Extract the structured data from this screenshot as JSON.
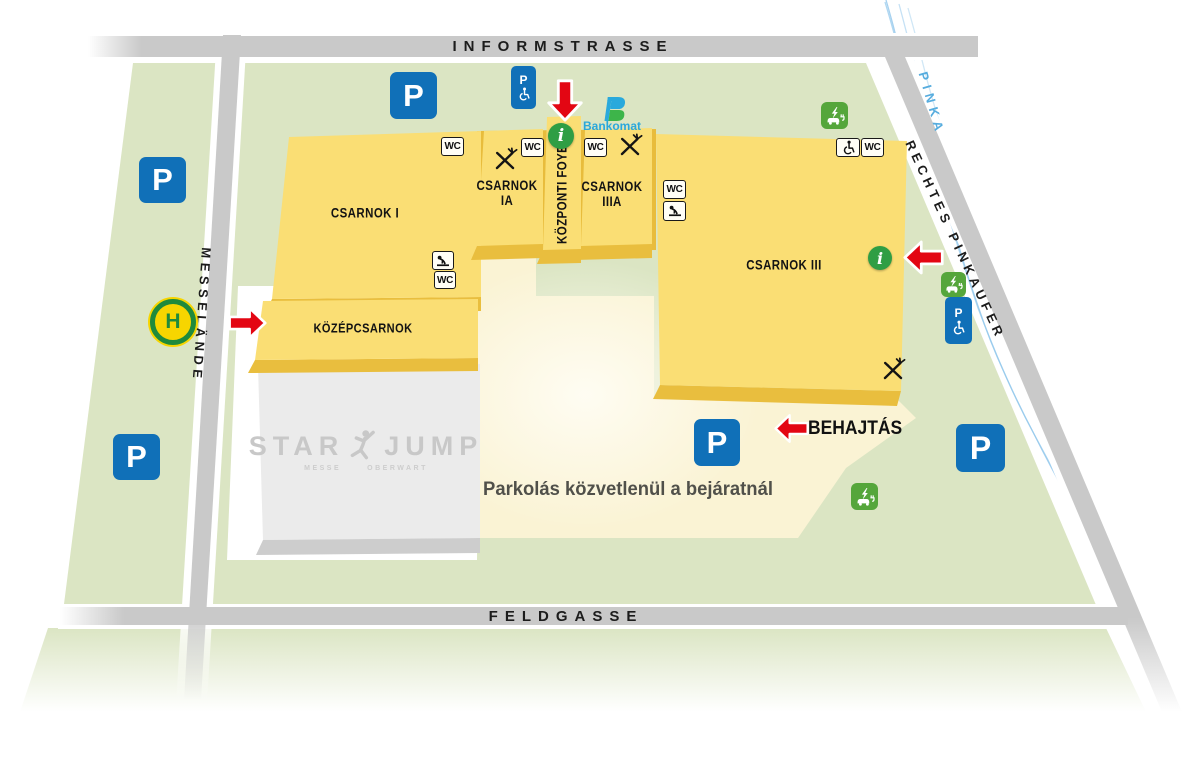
{
  "streets": {
    "informstrasse": "INFORMSTRASSE",
    "messelaende": "MESSELÄNDE",
    "rechtes_pinkaufer": "RECHTES PINKAUFER",
    "feldgasse": "FELDGASSE",
    "pinka": "PINKA"
  },
  "halls": {
    "hall1": "CSARNOK I",
    "hall1a_line1": "CSARNOK",
    "hall1a_line2": "IA",
    "foyer": "KÖZPONTI FOYER",
    "hall3a_line1": "CSARNOK",
    "hall3a_line2": "IIIA",
    "hall3": "CSARNOK III",
    "kozepcsarnok": "KÖZÉPCSARNOK"
  },
  "labels": {
    "behajtas": "BEHAJTÁS",
    "parking_note": "Parkolás közvetlenül a bejáratnál",
    "bankomat": "Bankomat"
  },
  "starjump": {
    "word_left": "STAR",
    "word_right": "JUMP",
    "sub_left": "MESSE",
    "sub_right": "OBERWART"
  },
  "glyphs": {
    "parking": "P",
    "bus_stop": "H",
    "wc": "WC",
    "info": "i"
  },
  "icon_names": [
    "parking-sign",
    "accessible-parking-sign",
    "bus-stop-sign",
    "info-icon",
    "ev-charging-icon",
    "wc-badge",
    "baby-changing-icon",
    "wheelchair-icon",
    "restaurant-icon",
    "entry-arrow",
    "bankomat-logo",
    "starjump-logo"
  ],
  "colors": {
    "building": "#FADE74",
    "building_edge": "#E9BE3E",
    "green_area": "#DBE5C3",
    "road": "#C9C9C9",
    "parking_lot": "#FAF3D4",
    "accent_red": "#E30613",
    "sign_blue": "#1070B8",
    "eco_green": "#55A63B",
    "info_green": "#2F9E44",
    "river_blue": "#96C9EC"
  }
}
